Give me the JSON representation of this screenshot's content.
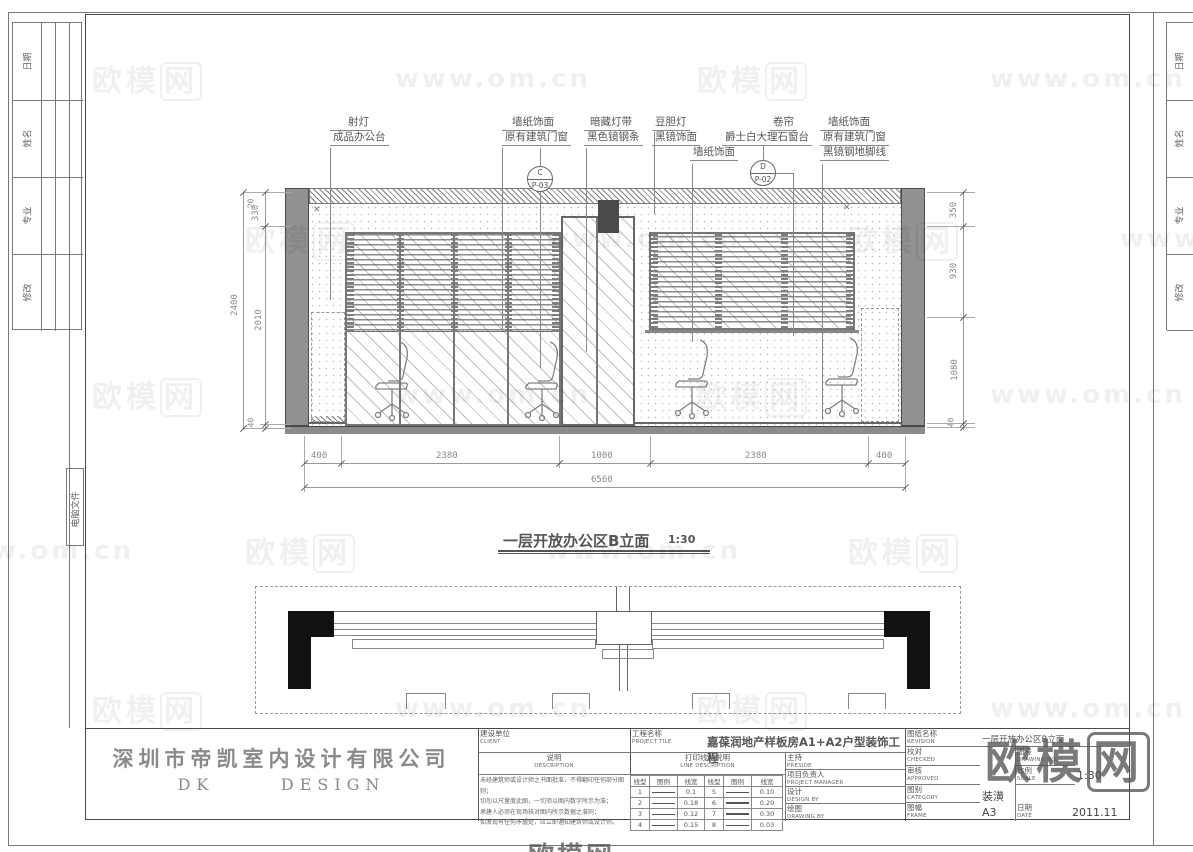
{
  "watermark": {
    "logo_part1": "欧模",
    "logo_part2": "网",
    "url_text": "www.om.cn"
  },
  "margin": {
    "left_rows": [
      "日期",
      "姓名",
      "专业",
      "修改"
    ],
    "file_strip": "电脑文件"
  },
  "annotations": {
    "l1a": "射灯",
    "l1b": "成品办公台",
    "l2a": "墙纸饰面",
    "l2b": "原有建筑门窗",
    "l3a": "暗藏灯带",
    "l3b": "黑色镜钢条",
    "l4a": "豆胆灯",
    "l4b": "黑镜饰面",
    "l4c": "墙纸饰面",
    "l5a": "卷帘",
    "l5b": "爵士白大理石窗台",
    "l6a": "墙纸饰面",
    "l6b": "原有建筑门窗",
    "l6c": "黑镜钢地脚线",
    "callout_c_letter": "C",
    "callout_c_no": "P-03",
    "callout_d_letter": "D",
    "callout_d_no": "P-02"
  },
  "dims": {
    "left_overall": "2400",
    "left_chain": [
      "20",
      "330",
      "2010",
      "40"
    ],
    "right_chain": [
      "350",
      "930",
      "1080",
      "40"
    ],
    "bottom_chain": [
      "400",
      "2380",
      "1000",
      "2380",
      "400"
    ],
    "bottom_overall": "6560"
  },
  "view_title": {
    "text": "一层开放办公区B立面",
    "scale": "1:30"
  },
  "company": {
    "name": "深圳市帝凯室内设计有限公司",
    "brand": "DK      DESIGN"
  },
  "tb": {
    "client_zh": "建设单位",
    "client_en": "CLIENT",
    "desc_zh": "说明",
    "desc_en": "DESCRIPTION",
    "desc_lines": [
      "未经建筑师或设计师之书面批准，不得翻印任何部分图则；",
      "切勿以尺量度此图，一切须以图内数字所示为准；",
      "承建人必须在现场核对图内所示数据之准则；",
      "如发现有任何矛盾处，应立即通知建筑师或设计师。"
    ],
    "project_zh": "工程名称",
    "project_en": "PROJECT TILE",
    "project_name": "嘉葆润地产样板房A1+A2户型装饰工程",
    "line_zh": "打印线型说明",
    "line_en": "LINE DESCRIPTION",
    "line_headers": [
      "线型",
      "图例",
      "线宽",
      "线型",
      "图例",
      "线宽"
    ],
    "line_rows": [
      [
        "1",
        "0.1",
        "5",
        "0.10"
      ],
      [
        "2",
        "0.18",
        "6",
        "0.20"
      ],
      [
        "3",
        "0.12",
        "7",
        "0.30"
      ],
      [
        "4",
        "0.15",
        "8",
        "0.03"
      ]
    ],
    "roles": [
      {
        "zh": "主持",
        "en": "PRESIDE"
      },
      {
        "zh": "项目负责人",
        "en": "PROJECT MANAGER"
      },
      {
        "zh": "设计",
        "en": "DESIGN BY"
      },
      {
        "zh": "绘图",
        "en": "DRAWING BY"
      }
    ],
    "rev_zh": "图纸名称",
    "rev_en": "REVISION",
    "rev_value": "一层开放办公区B立面",
    "checked_zh": "校对",
    "checked_en": "CHECKED",
    "approved_zh": "审核",
    "approved_en": "APPROVED",
    "dno_zh": "图号",
    "dno_en": "DRAWING NO.",
    "scale_zh": "比例",
    "scale_en": "SCALE",
    "scale_value": "1:30",
    "cat_zh": "图别",
    "cat_en": "CATEGORY",
    "cat_value": "装潢",
    "frame_zh": "图幅",
    "frame_en": "FRAME",
    "frame_value": "A3",
    "date_zh": "日期",
    "date_en": "DATE",
    "date_value": "2011.11"
  }
}
